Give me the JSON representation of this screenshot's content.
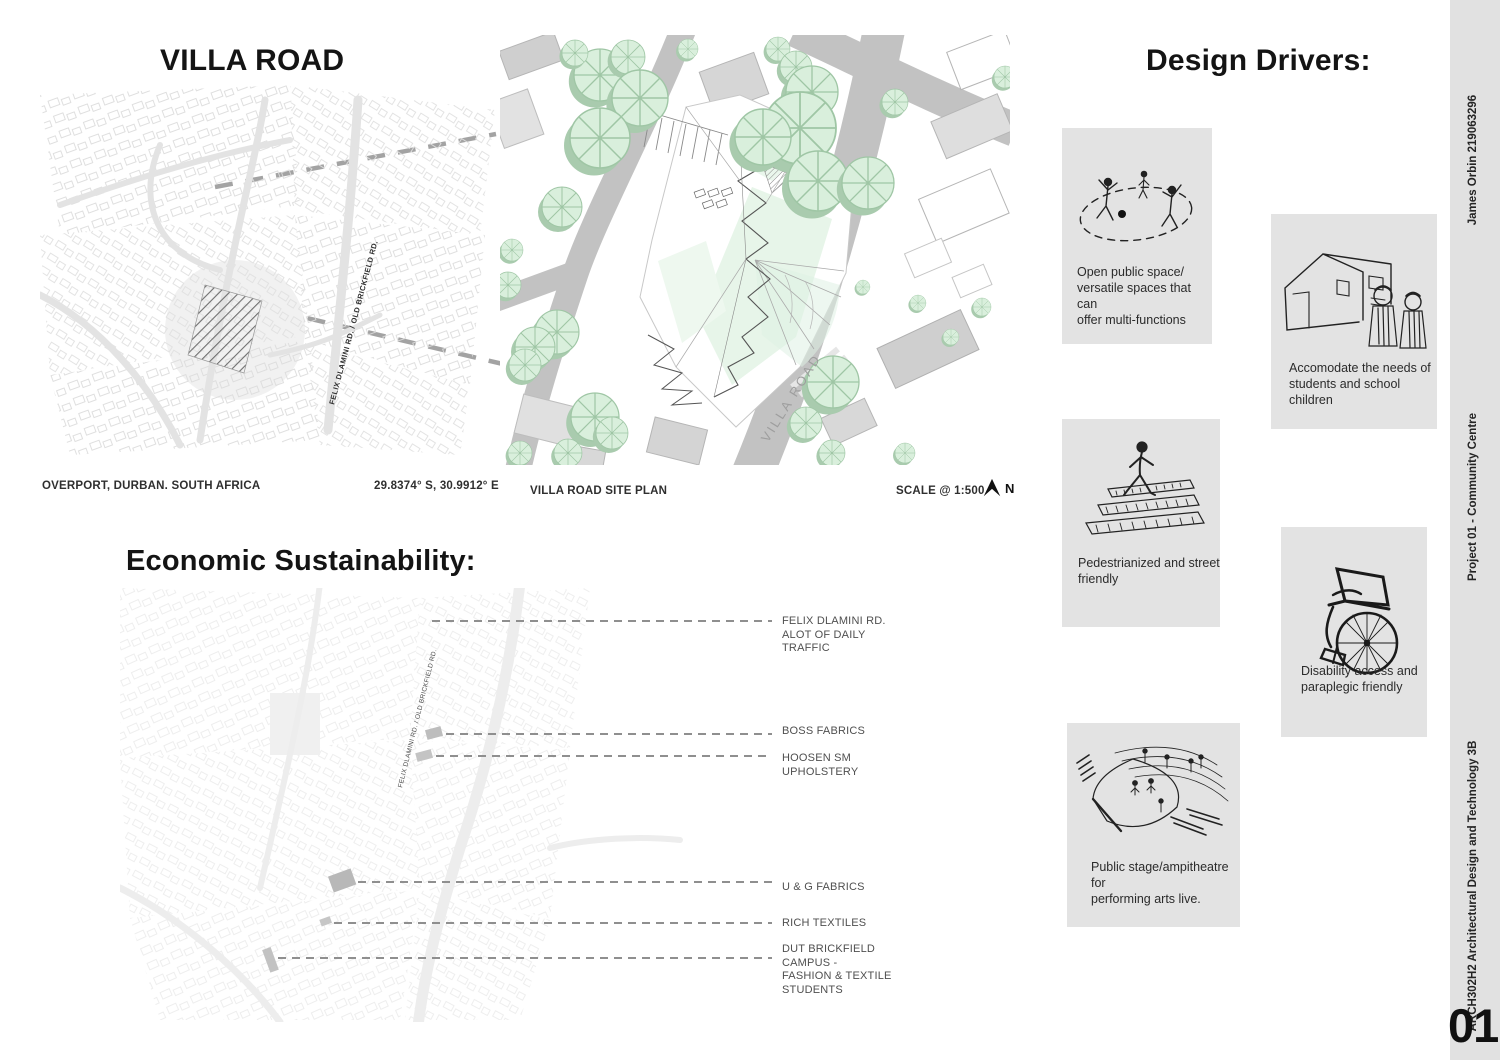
{
  "villa_road": {
    "title": "VILLA ROAD",
    "location": "OVERPORT, DURBAN. SOUTH AFRICA",
    "coordinates": "29.8374° S, 30.9912° E",
    "context_road_label": "FELIX DLAMINI RD. / OLD BRICKFIELD RD."
  },
  "site_plan": {
    "caption": "VILLA ROAD SITE PLAN",
    "scale": "SCALE @ 1:500",
    "north_label": "N",
    "road_label": "VILLA ROAD"
  },
  "design_drivers": {
    "title": "Design Drivers:",
    "items": [
      {
        "icon": "people-playing-icon",
        "caption": "Open public space/\nversatile spaces that can\noffer multi-functions"
      },
      {
        "icon": "school-children-icon",
        "caption": "Accomodate the needs of\nstudents and school children"
      },
      {
        "icon": "pedestrian-crossing-icon",
        "caption": "Pedestrianized and street\nfriendly"
      },
      {
        "icon": "wheelchair-icon",
        "caption": "Disability access and\nparaplegic friendly"
      },
      {
        "icon": "amphitheatre-icon",
        "caption": "Public stage/ampitheatre for\nperforming arts live."
      }
    ]
  },
  "economic": {
    "title": "Economic Sustainability:",
    "road_label": "FELIX DLAMINI RD. / OLD BRICKFIELD RD.",
    "labels": [
      "FELIX DLAMINI RD.\nALOT OF DAILY\nTRAFFIC",
      "BOSS FABRICS",
      "HOOSEN SM\nUPHOLSTERY",
      "U & G FABRICS",
      "RICH TEXTILES",
      "DUT BRICKFIELD\nCAMPUS -\nFASHION & TEXTILE\nSTUDENTS"
    ]
  },
  "sidebar": {
    "student": "James Orbin 219063296",
    "project": "Project 01 - Community Centre",
    "course": "ARCH302H2 Architectural Design and Technology 3B",
    "page_number": "01"
  },
  "colors": {
    "tree_green": "#d9efdc",
    "tree_shadow_green": "#a9cbae",
    "road_gray": "#c2c2c2",
    "driver_box_gray": "#e3e3e3",
    "sidebar_gray": "#e1e1e1",
    "leader_gray": "#a3a3a3"
  }
}
